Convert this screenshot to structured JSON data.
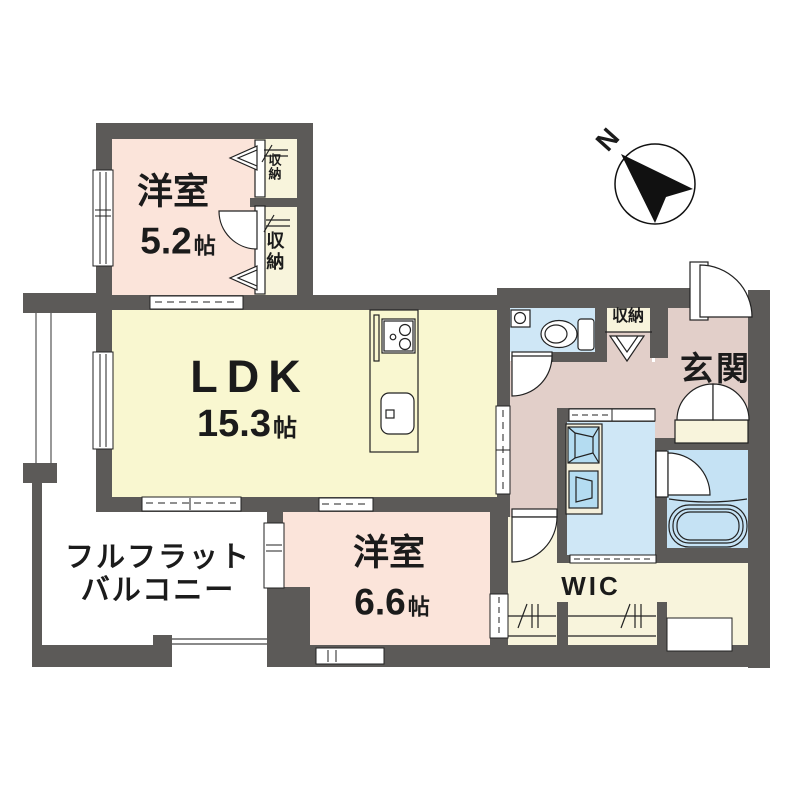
{
  "plan": {
    "compass": {
      "north_label": "N"
    },
    "rooms": {
      "bedroom1": {
        "name": "洋室",
        "size": "5.2",
        "unit": "帖"
      },
      "ldk": {
        "name": "LDK",
        "size": "15.3",
        "unit": "帖"
      },
      "bedroom2": {
        "name": "洋室",
        "size": "6.6",
        "unit": "帖"
      },
      "balcony": {
        "line1": "フルフラット",
        "line2": "バルコニー"
      },
      "entrance": {
        "name": "玄関"
      },
      "wic": {
        "name": "WIC"
      },
      "storage_upper": {
        "name": "収納"
      },
      "storage_lower": {
        "name": "収納"
      },
      "storage_hall": {
        "name": "収納"
      }
    },
    "palette": {
      "wall": "#5c5a58",
      "bedroom_pink": "#fbe4da",
      "ldk_yellow": "#f9f7d0",
      "hall_mauve": "#e2cfc9",
      "closet_cream": "#f8f4dc",
      "water_blue": "#cfe7f6",
      "fixture_blue": "#b4dcf1",
      "line": "#1f1f1f"
    }
  }
}
